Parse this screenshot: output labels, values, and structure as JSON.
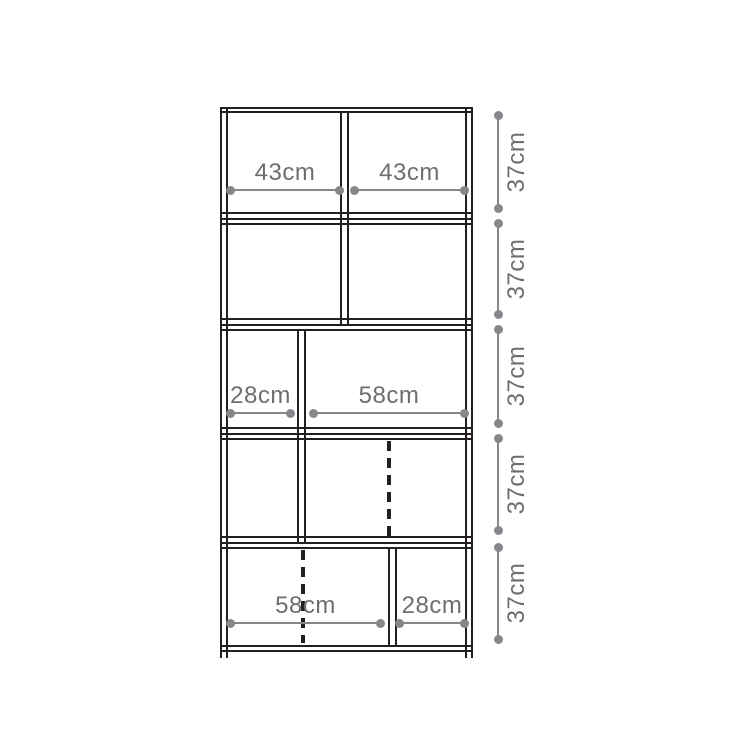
{
  "diagram": {
    "type": "furniture-dimension-diagram",
    "subject": "5-tier shelf unit, front elevation with compartment dimensions",
    "unit": "cm",
    "colors": {
      "outline": "#231f20",
      "dimension_line": "#85878a",
      "dimension_text": "#6d6e71",
      "background": "#ffffff"
    },
    "width_dims": {
      "row1_left": "43cm",
      "row1_right": "43cm",
      "row3_left": "28cm",
      "row3_right": "58cm",
      "row5_left": "58cm",
      "row5_right": "28cm"
    },
    "height_dims": [
      "37cm",
      "37cm",
      "37cm",
      "37cm",
      "37cm"
    ]
  }
}
